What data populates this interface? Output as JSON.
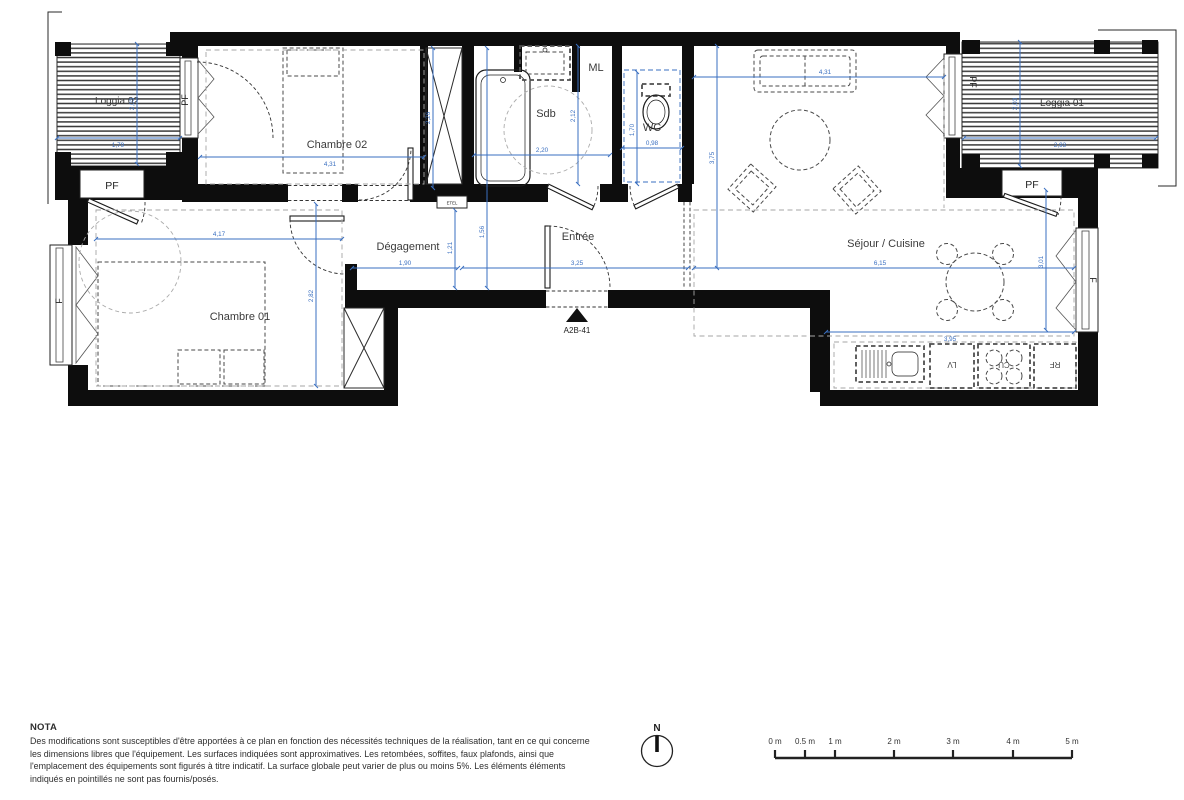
{
  "colors": {
    "dimension": "#3a6fc0",
    "wall": "#0d0d0d"
  },
  "plan": {
    "rooms": {
      "loggia02": {
        "label": "Loggia 02",
        "width": "1,79",
        "height": "2,03"
      },
      "chambre02": {
        "label": "Chambre 02",
        "width": "4,31",
        "shaft_height": "2,26"
      },
      "sdb": {
        "label": "Sdb",
        "width": "2,20",
        "height": "2,12"
      },
      "ml": {
        "label": "ML"
      },
      "wc": {
        "label": "WC",
        "width": "0,98",
        "height": "1,70"
      },
      "sejour": {
        "label": "Séjour / Cuisine",
        "width_top": "4,31",
        "height_left": "3,75",
        "width_mid": "6,15",
        "width_low": "3,95",
        "height_right": "3,01"
      },
      "loggia01": {
        "label": "Loggia 01",
        "width": "2,93",
        "height": "2,03"
      },
      "chambre01": {
        "label": "Chambre 01",
        "width": "4,17",
        "height": "2,82"
      },
      "degagement": {
        "label": "Dégagement",
        "width": "1,90",
        "height_a": "1,21",
        "height_b": "1,56"
      },
      "entree": {
        "label": "Entrée",
        "width": "3,25"
      }
    },
    "labels": {
      "pf": "PF",
      "f": "F",
      "etel": "ETEL"
    },
    "kitchen": {
      "lv": "LV",
      "cu": "CU",
      "rf": "RF"
    },
    "unit_code": "A2B-41"
  },
  "nota": {
    "title": "NOTA",
    "body": "Des modifications sont susceptibles d'être apportées à ce plan en fonction des nécessités techniques de la réalisation, tant en ce qui concerne les dimensions libres que l'équipement. Les surfaces indiquées sont approximatives. Les retombées, soffites, faux plafonds, ainsi que l'emplacement des équipements sont figurés à titre indicatif. La surface globale peut varier de plus ou moins 5%. Les éléments éléments indiqués en pointillés ne sont pas fournis/posés."
  },
  "compass": {
    "label": "N"
  },
  "scalebar": {
    "ticks": [
      "0 m",
      "0.5 m",
      "1 m",
      "2 m",
      "3 m",
      "4 m",
      "5 m"
    ]
  }
}
